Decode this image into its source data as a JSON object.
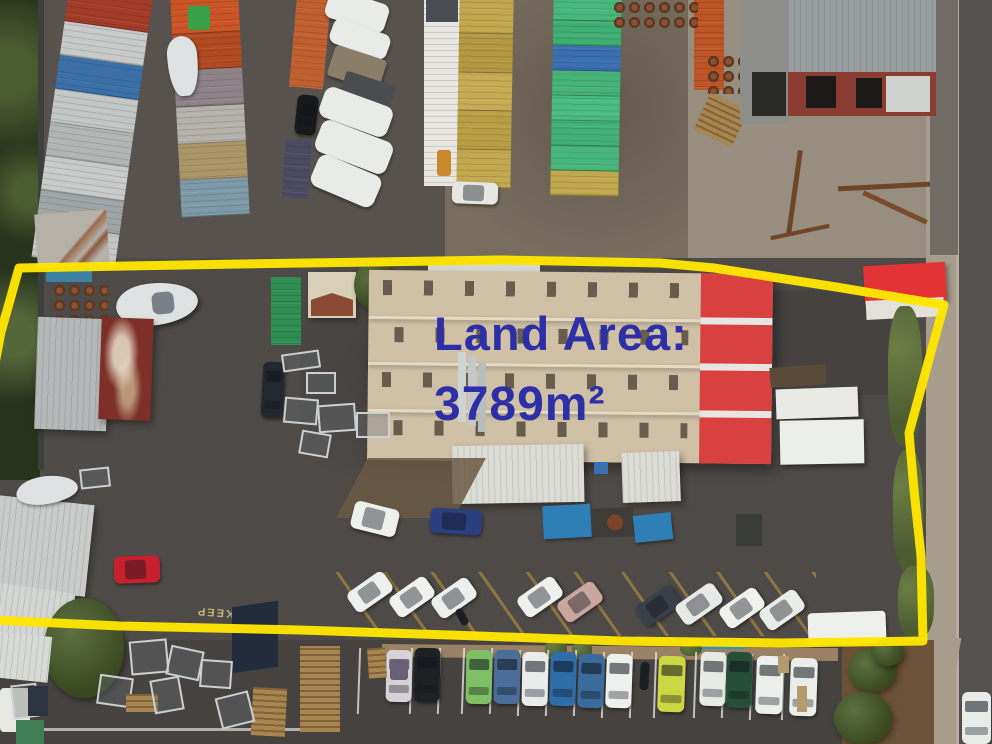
{
  "annotation": {
    "line1": "Land Area:",
    "line2": "3789m²",
    "color": "#2c2fa5"
  },
  "boundary": {
    "color": "#ffe600"
  },
  "ground_text": {
    "keep": "KEEP"
  },
  "palette": {
    "asphalt": "#4e4a47",
    "asphalt_dark": "#454240",
    "gravel": "#776e60",
    "gravel_dark": "#57524d",
    "concrete": "#978e7f",
    "road": "#56524f",
    "footpath": "#a79d8d",
    "kerb": "#9b8264",
    "mulch": "#6b5238",
    "tree_strip": "#27331b",
    "fence": "#3c403c",
    "apron_brown": "#6b5844",
    "grass_weeds": "#5c6b3d"
  },
  "container_rows": {
    "far_left": [
      "#a23b28",
      "#c7cac9",
      "#3a6fa8",
      "#c2c6c5",
      "#b2b6b5",
      "#c8cbca",
      "#9fa5a6",
      "#c4c7c6"
    ],
    "left_stack": [
      "#cc5526",
      "#b14a20",
      "#8d8288",
      "#b5b1ab",
      "#ab9668",
      "#7e9aa9"
    ],
    "yellow_row": [
      "#c0a84e",
      "#b39a42",
      "#c6ad55",
      "#b89f46",
      "#c2a950"
    ],
    "green_row": [
      "#49b87c",
      "#3fae72",
      "#3a6fb0",
      "#45b476",
      "#4bbc80",
      "#41b074",
      "#47b67a",
      "#c0a84e"
    ],
    "orange_single": "#c06030",
    "orange_right": "#bd5526",
    "purple_container": "#4a4a63",
    "green_container_yard": "#2f8e52",
    "blue_tarp": "#3c80a2"
  },
  "structures": {
    "warehouse_roof": "#cfc0a6",
    "warehouse_red": "#d94040",
    "warehouse_white_band": "#e8e6e2",
    "canopy": "#dcdcd6",
    "brick_roof": "#9aa0a2",
    "brick_wall": "#8a3c30",
    "block_wall": "#8d8d89",
    "grey_building": "#b5b8b9",
    "red_building": "#7d2f28",
    "silver_building": "#c9cccb",
    "cream_shed_wall": "#d8cfb8",
    "cream_shed_roof": "#8a4a33",
    "red_shed": "#e23434",
    "rusty_shed": "#b5b0a8",
    "navy_tarp": "#232c3d"
  },
  "vehicles": {
    "yard_row": [
      "#eef0ee",
      "#f0f1ef",
      "#edefee",
      "#eef0ed",
      "#c9a69e",
      "#3a4048",
      "#e8eae8",
      "#eff1ee",
      "#eaece9"
    ],
    "street_row": [
      "#d6d2d8",
      "#1e2124",
      "#7fc066",
      "#4a6e99",
      "#e9ecea",
      "#2e6da8",
      "#3b6b9b",
      "#eef0ed",
      "#cdd643",
      "#e8eae6",
      "#274e38",
      "#ecefec",
      "#eaedea"
    ],
    "red_hatchback": "#c7202c",
    "black_car": "#17191b",
    "blue_sedan": "#2a3f7e",
    "white_car_upper": "#eef0ee",
    "navy_wagon": "#23272e",
    "white_van_right": "#eef0ec",
    "white_van_left": "#e8e8e2",
    "white_ute_top": "#e6e7e3",
    "white_truck": "#e8e6e0",
    "forklift": "#c8872a",
    "white_car_road": "#e9ebe8",
    "boat_hull": "#dfe2e2",
    "caravan": "#e9ebe8",
    "caravan_dark": "#4a4d50",
    "caravan_tan": "#8a7d6a",
    "motorcycle": "#1b1e22",
    "blue_bin": "#2e7fb5",
    "dark_trailer": "#3f3b37",
    "green_bin": "#3f7d54"
  }
}
